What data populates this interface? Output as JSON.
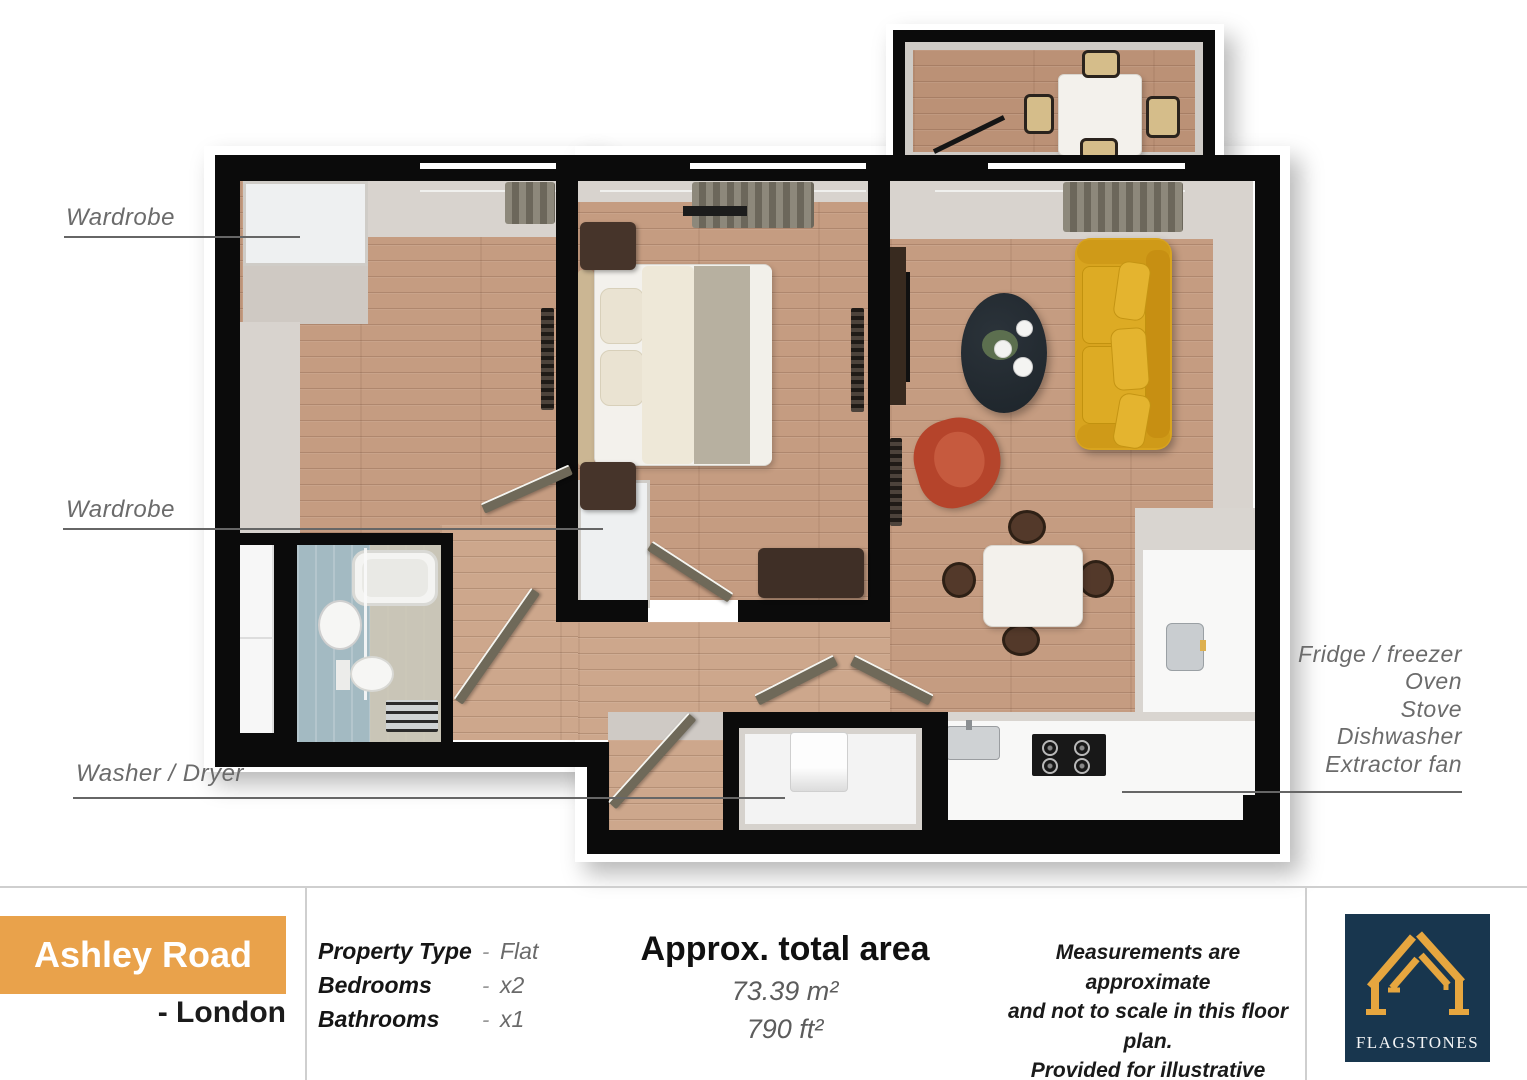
{
  "plan": {
    "labels": {
      "wardrobe_top": "Wardrobe",
      "wardrobe_mid": "Wardrobe",
      "washer_dryer": "Washer / Dryer",
      "kitchen_items": [
        "Fridge / freezer",
        "Oven",
        "Stove",
        "Dishwasher",
        "Extractor fan"
      ]
    }
  },
  "footer": {
    "property_name": "Ashley Road",
    "property_location": "- London",
    "details": [
      {
        "label": "Property Type",
        "sep": "-",
        "value": "Flat"
      },
      {
        "label": "Bedrooms",
        "sep": "-",
        "value": "x2"
      },
      {
        "label": "Bathrooms",
        "sep": "-",
        "value": "x1"
      }
    ],
    "area_title": "Approx. total area",
    "area_m2": "73.39 m²",
    "area_ft2": "790 ft²",
    "disclaimer_lines": [
      "Measurements are  approximate",
      "and not to scale in this floor plan.",
      "Provided for illustrative purposes."
    ],
    "brand": "FLAGSTONES"
  },
  "colors": {
    "accent_orange": "#e9a24b",
    "brand_navy": "#18364e",
    "brand_gold": "#e6a63f",
    "wall_black": "#0b0b0b",
    "wood_floor": "#c59c81",
    "sofa_yellow": "#d8a41f",
    "armchair_red": "#b5442b",
    "bathroom_blue": "#a3bac2",
    "label_gray": "#6b6b6b"
  }
}
